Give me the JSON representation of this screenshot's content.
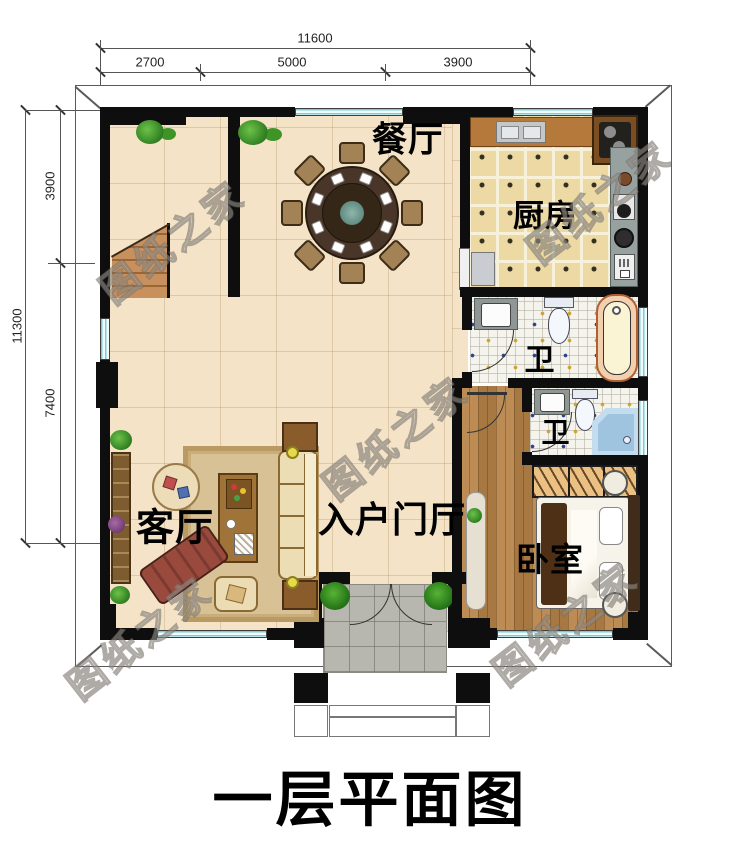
{
  "title": "一层平面图",
  "watermark": "图纸之家",
  "dimensions": {
    "top": {
      "total": "11600",
      "segments": [
        "2700",
        "5000",
        "3900"
      ]
    },
    "left": {
      "total": "11300",
      "segments": [
        "3900",
        "7400"
      ]
    }
  },
  "rooms": {
    "dining": "餐厅",
    "kitchen": "厨房",
    "bath_upper": "卫",
    "bath_lower": "卫",
    "living": "客厅",
    "foyer": "入户门厅",
    "bedroom": "卧室"
  },
  "colors": {
    "wall": "#0e0e0e",
    "window": "#79ccd1",
    "floor_main": "#f4e3c7",
    "floor_kitchen": "#ecd9a4",
    "floor_bedroom": "#b5834b",
    "porch": "#b7b7af"
  }
}
